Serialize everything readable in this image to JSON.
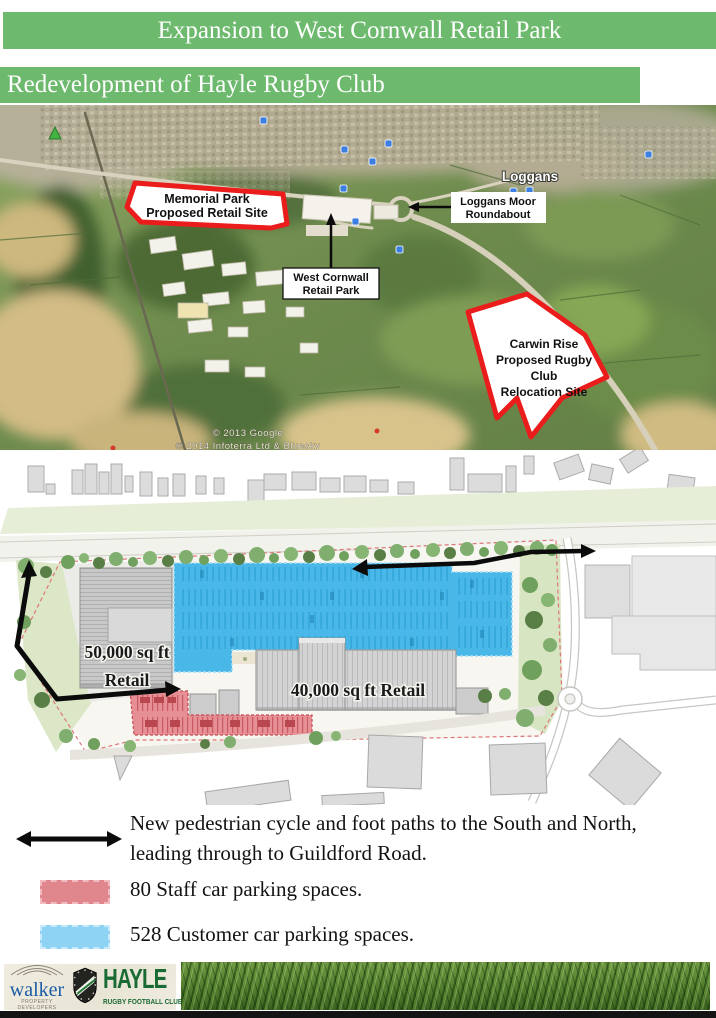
{
  "page": {
    "title_banner": "Expansion to West Cornwall Retail Park",
    "subtitle_banner": "Redevelopment of Hayle Rugby Club"
  },
  "map": {
    "place_label": "Loggans",
    "memorial_site": {
      "line1": "Memorial Park",
      "line2": "Proposed Retail Site"
    },
    "roundabout_label": {
      "line1": "Loggans Moor",
      "line2": "Roundabout"
    },
    "retail_park_label": {
      "line1": "West Cornwall",
      "line2": "Retail Park"
    },
    "carwin_site": {
      "line1": "Carwin Rise",
      "line2": "Proposed Rugby",
      "line3": "Club",
      "line4": "Relocation Site"
    },
    "copyright_line1": "© 2013 Google",
    "copyright_line2": "© 2014 Infoterra Ltd & Bluesky"
  },
  "site_plan": {
    "retail_50k": {
      "line1": "50,000 sq ft",
      "line2": "Retail"
    },
    "retail_40k": "40,000 sq ft Retail"
  },
  "legend": {
    "paths_line1": "New pedestrian cycle and foot paths to the South and North,",
    "paths_line2": "leading through to Guildford Road.",
    "staff_parking": "80 Staff car parking spaces.",
    "customer_parking": "528 Customer car parking spaces."
  },
  "footer": {
    "developer_name": "walker",
    "developer_tagline": "PROPERTY DEVELOPERS",
    "club_name": "HAYLE",
    "club_subtitle": "RUGBY FOOTBALL CLUB"
  },
  "colors": {
    "banner_green": "#6db96d",
    "site_outline_red": "#ea1c1c",
    "customer_parking_blue": "#49b8e9",
    "staff_parking_pink": "#e4868c",
    "legend_customer_blue": "#8ed3f3",
    "legend_staff_pink": "#e0868d",
    "path_arrow_black": "#0b0b0b"
  }
}
